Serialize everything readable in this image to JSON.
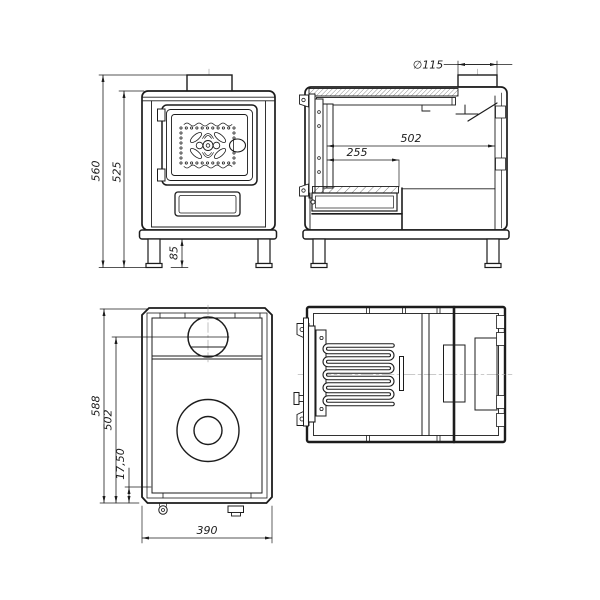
{
  "drawing": {
    "colors": {
      "background": "#ffffff",
      "line": "#1c1c1c",
      "centerline": "#999999"
    },
    "views": {
      "front": {
        "dim_overall_height": "560",
        "dim_body_height": "525",
        "dim_leg_height": "85"
      },
      "side": {
        "dim_flue_diameter": "∅115",
        "dim_inner_depth": "502",
        "dim_firebox_depth": "255"
      },
      "plan": {
        "dim_overall_depth": "588",
        "dim_plate_depth": "502",
        "dim_front_offset": "17,50",
        "dim_overall_width": "390"
      }
    }
  }
}
